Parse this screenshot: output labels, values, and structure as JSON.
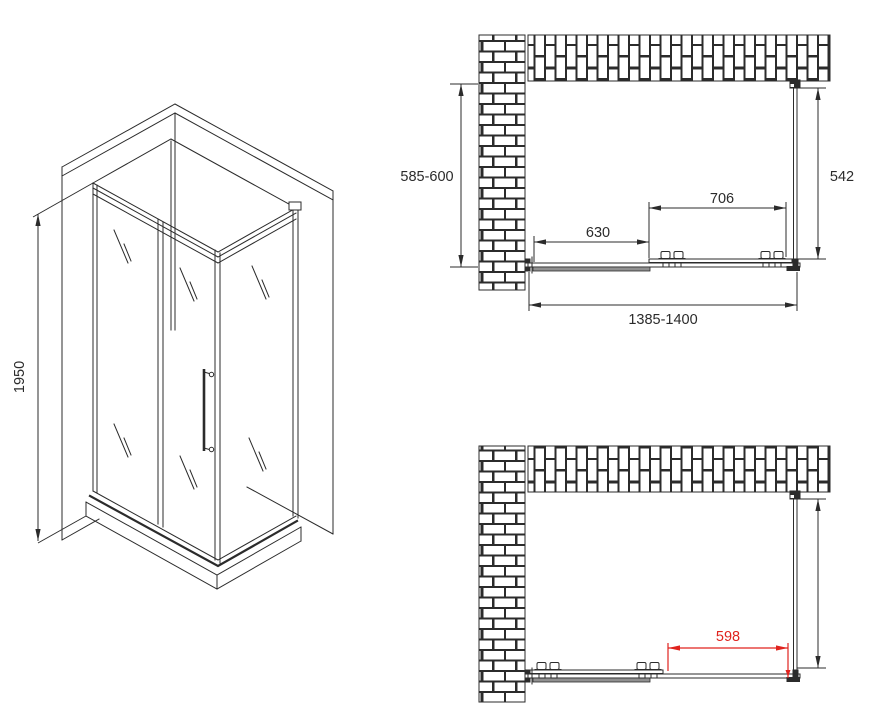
{
  "drawing_type": "shower-enclosure-technical-drawing",
  "isometric": {
    "height": "1950"
  },
  "plan_closed": {
    "depth": "585-600",
    "side": "542",
    "door": "706",
    "fixed_panel": "630",
    "width": "1385-1400"
  },
  "plan_open": {
    "opening": "598"
  },
  "colors": {
    "line": "#2b2b2b",
    "dimension_red": "#e0231e",
    "panel_gray": "#909090",
    "background": "#ffffff"
  }
}
